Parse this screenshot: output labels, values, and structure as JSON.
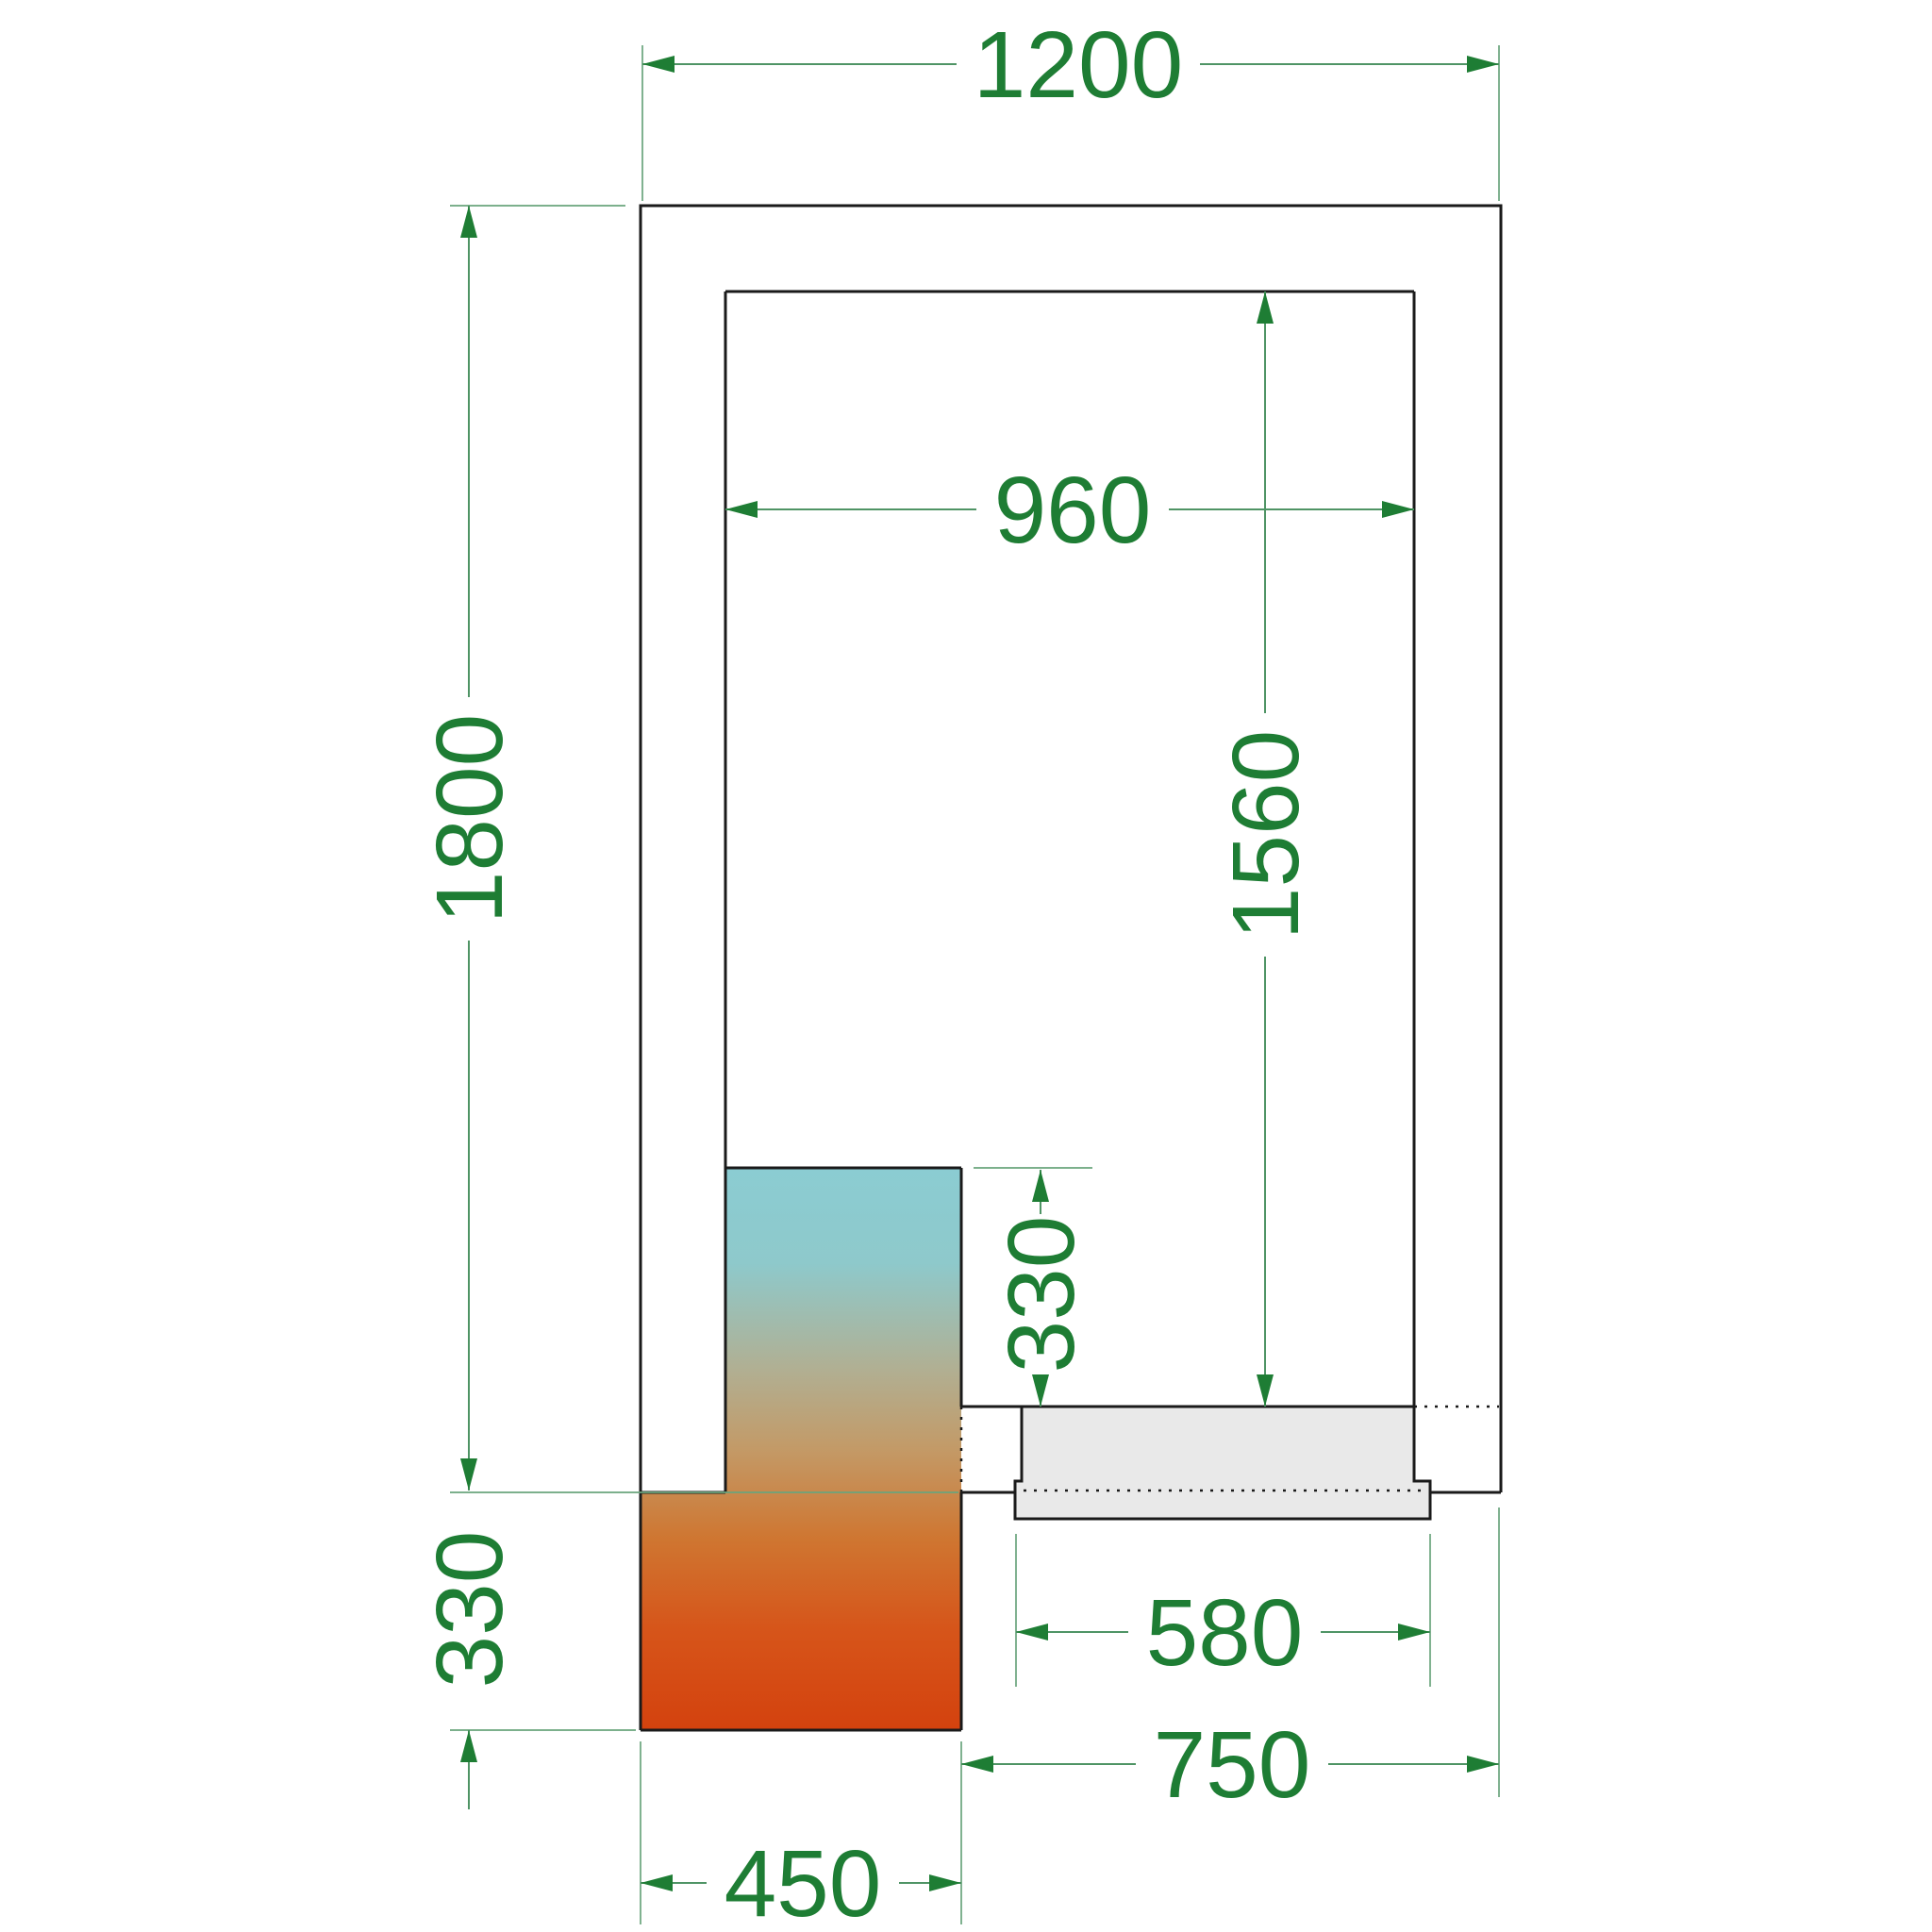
{
  "drawing": {
    "type": "technical-floor-plan",
    "background_color": "#ffffff",
    "outline_color": "#1a1a1a",
    "dimension_text_color": "#1e7d34",
    "dimension_line_color": "#4f9465",
    "door_fill_color": "#e9e9e9",
    "heatmap_unit": {
      "top_color": "#8bccd2",
      "mid_color": "#c39a67",
      "bottom_color": "#d4420e"
    },
    "dimensions": {
      "outer_width": {
        "label": "1200",
        "orientation": "horizontal",
        "location": "top"
      },
      "inner_width": {
        "label": "960",
        "orientation": "horizontal",
        "location": "inside-top"
      },
      "outer_height": {
        "label": "1800",
        "orientation": "vertical",
        "location": "left"
      },
      "inner_height": {
        "label": "1560",
        "orientation": "vertical",
        "location": "inside-right"
      },
      "unit_inside_depth": {
        "label": "330",
        "orientation": "vertical",
        "location": "inside-near-door"
      },
      "unit_outside_depth": {
        "label": "330",
        "orientation": "vertical",
        "location": "bottom-left"
      },
      "door_width": {
        "label": "580",
        "orientation": "horizontal",
        "location": "below-door"
      },
      "door_clearance": {
        "label": "750",
        "orientation": "horizontal",
        "location": "bottom-right"
      },
      "unit_width": {
        "label": "450",
        "orientation": "horizontal",
        "location": "bottom"
      }
    }
  }
}
